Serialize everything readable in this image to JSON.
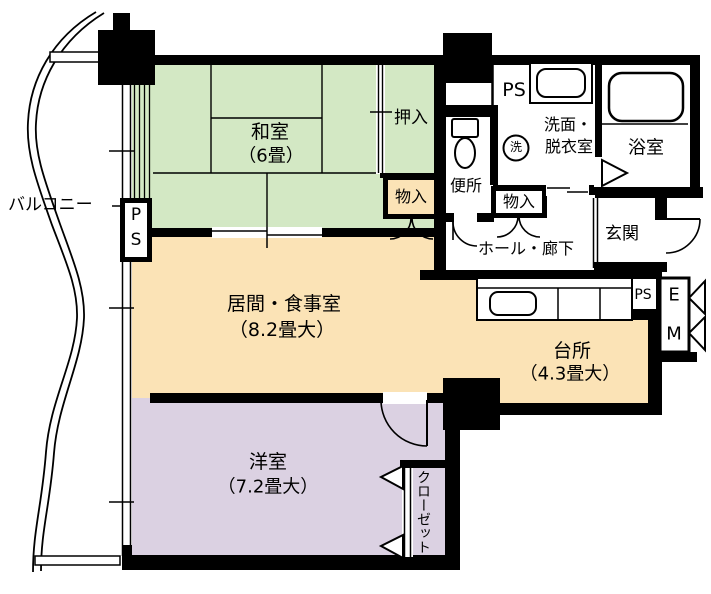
{
  "floorplan": {
    "balcony_label": "バルコニー",
    "washitsu_name": "和室",
    "washitsu_size": "（6畳）",
    "oshiire_label": "押入",
    "storage_upper_label": "物入",
    "toilet_label": "便所",
    "ps_top_label": "PS",
    "washroom_line1": "洗面・",
    "washroom_line2": "脱衣室",
    "washer_symbol": "洗",
    "bath_label": "浴室",
    "storage_hall_label": "物入",
    "hall_label": "ホール・廊下",
    "genkan_label": "玄関",
    "living_name": "居間・食事室",
    "living_size": "（8.2畳大）",
    "kitchen_name": "台所",
    "kitchen_size": "（4.3畳大）",
    "western_name": "洋室",
    "western_size": "（7.2畳大）",
    "closet_label": "クローゼット",
    "ps_left_p": "P",
    "ps_left_s": "S",
    "ps_kitchen_label": "PS",
    "ev_e": "E",
    "ev_m": "M",
    "colors": {
      "tatami_green": "#d3e8c4",
      "living_orange": "#fbe3b6",
      "bedroom_purple": "#dbd1e2",
      "wall_black": "#000000"
    }
  }
}
